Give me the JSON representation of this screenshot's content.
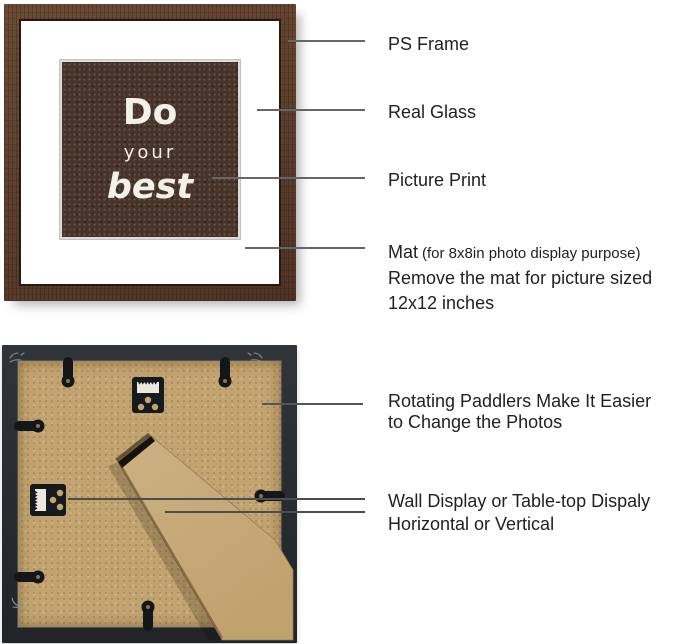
{
  "colors": {
    "front_frame_wood": "#5d4030",
    "picture_brown": "#46332a",
    "mat_white": "#ffffff",
    "back_frame_black": "#26292d",
    "back_panel_kraft": "#c2a470",
    "easel_kraft": "#c9ac7c",
    "leader_line_gray": "#666666",
    "label_text": "#212121"
  },
  "front_view": {
    "picture_text": {
      "word1": "Do",
      "word2": "your",
      "word3": "best"
    }
  },
  "back_view": {
    "icons": [
      "rotating-paddle-clip",
      "sawtooth-hanger",
      "easel-stand",
      "corner-scratch-mark"
    ]
  },
  "callouts": {
    "ps_frame": {
      "label": "PS Frame"
    },
    "real_glass": {
      "label": "Real Glass"
    },
    "picture_print": {
      "label": "Picture Print"
    },
    "mat": {
      "label_main": "Mat",
      "label_detail": "(for 8x8in photo display purpose)",
      "line2": "Remove the mat for picture sized",
      "line3": "12x12 inches"
    },
    "rotating_paddlers": {
      "line1": "Rotating Paddlers Make It Easier",
      "line2": "to Change the Photos"
    },
    "display_mode": {
      "line1": "Wall Display or Table-top Dispaly",
      "line2": "Horizontal or Vertical"
    }
  }
}
